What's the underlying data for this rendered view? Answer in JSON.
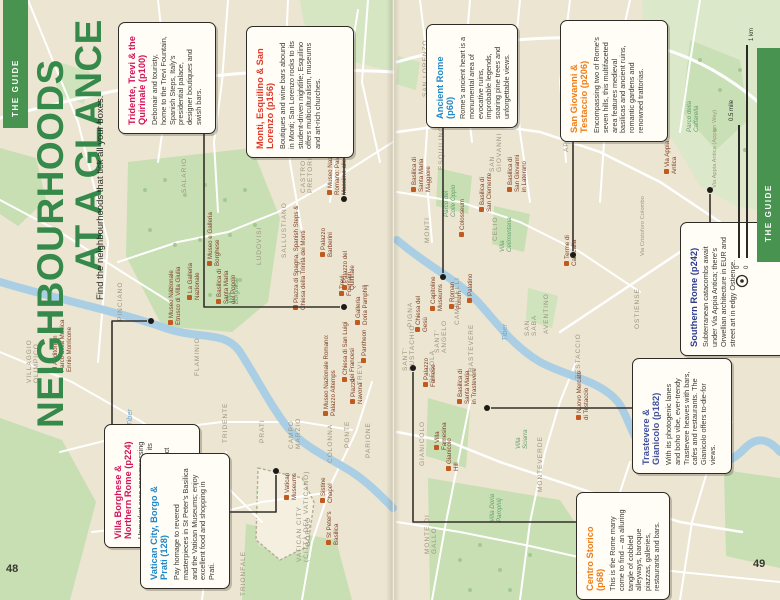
{
  "page": {
    "left_number": "48",
    "right_number": "49"
  },
  "guide_tab": "THE GUIDE",
  "header": {
    "title_line1": "NEIGHBOURHOODS",
    "title_line2": "AT A GLANCE",
    "subtitle": "Find the neighbourhoods that tick all your boxes.",
    "title_color": "#35894a"
  },
  "scale_bar": {
    "km_label": "1 km",
    "mile_label": "0.5 mile",
    "zero_km": "0",
    "zero_mile": "0"
  },
  "colors": {
    "band_green": "#47934f",
    "park_green": "#c7dfb3",
    "river_blue": "#aacfe5",
    "map_beige": "#ece5d1"
  },
  "callouts": [
    {
      "id": "tridente",
      "title": "Tridente, Trevi & the Quirinale (p100)",
      "color": "#d4145a",
      "body": "Debonair and touristy, home to the Trevi Fountain, Spanish Steps, Italy's presidential palace, designer boutiques and swish bars.",
      "box": [
        118,
        22,
        96,
        110
      ],
      "leader": [
        [
          204,
          132
        ],
        [
          204,
          307
        ],
        [
          340,
          307
        ]
      ],
      "dot": [
        344,
        307
      ]
    },
    {
      "id": "monti",
      "title": "Monti, Esquilino & San Lorenzo (p156)",
      "color": "#e0392a",
      "body": "Boutiques and wine bars abound in Monti; San Lorenzo rocks to its student-driven nightlife; Esquilino offers multiculturalism, museums and art-rich churches.",
      "box": [
        246,
        26,
        106,
        130
      ],
      "leader": [
        [
          344,
          156
        ],
        [
          344,
          195
        ]
      ],
      "dot": [
        344,
        199
      ]
    },
    {
      "id": "ancient-rome",
      "title": "Ancient Rome (p60)",
      "color": "#1f88c9",
      "body": "Rome's ancient heart is a monumental area of evocative ruins, improbable legends, soaring pine trees and unforgettable views.",
      "box": [
        426,
        24,
        90,
        102
      ],
      "leader": [
        [
          443,
          126
        ],
        [
          443,
          273
        ]
      ],
      "dot": [
        443,
        277
      ]
    },
    {
      "id": "san-giovanni",
      "title": "San Giovanni & Testaccio (p206)",
      "color": "#ef7d17",
      "body": "Encompassing two of Rome's seven hills, this multifaceted area features medieval basilicas and ancient ruins, romantic gardens and renowned trattorias.",
      "box": [
        560,
        20,
        106,
        120
      ],
      "leader": [
        [
          573,
          140
        ],
        [
          573,
          251
        ]
      ],
      "dot": [
        573,
        255
      ]
    },
    {
      "id": "villa-borghese",
      "title": "Villa Borghese & Northern Rome (p224)",
      "color": "#d4145a",
      "body": "Upmarket area encompassing Rome's most famous park, its top concert venue, most expensive residential district and several superlative museums.",
      "box": [
        104,
        424,
        94,
        122
      ],
      "leader": [
        [
          112,
          424
        ],
        [
          112,
          321
        ],
        [
          147,
          321
        ]
      ],
      "dot": [
        151,
        321
      ]
    },
    {
      "id": "vatican-city",
      "title": "Vatican City, Borgo & Prati (128)",
      "color": "#1f88c9",
      "body": "Pay homage to revered masterpieces in St Peter's Basilica and the Vatican Museums; enjoy excellent food and shopping in Prati.",
      "box": [
        140,
        453,
        88,
        134
      ],
      "leader": [
        [
          228,
          512
        ],
        [
          276,
          512
        ],
        [
          276,
          475
        ]
      ],
      "dot": [
        276,
        471
      ]
    },
    {
      "id": "southern-rome",
      "title": "Southern Rome (p242)",
      "color": "#2e3d8f",
      "body": "Subterranean catacombs await under Via Appia Antica; there's Orwellian architecture in EUR and street art in edgy Ostiense.",
      "box": [
        680,
        222,
        104,
        132
      ],
      "leader": [
        [
          710,
          222
        ],
        [
          710,
          194
        ]
      ],
      "dot": [
        710,
        190
      ]
    },
    {
      "id": "trastevere",
      "title": "Trastevere & Gianicolo (p182)",
      "color": "#41519e",
      "body": "With its photogenic lanes and boho vibe, ever-trendy Trastevere heaves with bars, cafes and restaurants. The Gianicolo offers to-die-for views.",
      "box": [
        632,
        358,
        98,
        114
      ],
      "leader": [
        [
          632,
          408
        ],
        [
          491,
          408
        ]
      ],
      "dot": [
        487,
        408
      ]
    },
    {
      "id": "centro-storico",
      "title": "Centro Storico (p68)",
      "color": "#ef7d17",
      "body": "This is the Rome many come to find – an alluring tangle of cobbled alleyways, baroque piazzas, galleries, restaurants and bars.",
      "box": [
        576,
        492,
        92,
        106
      ],
      "leader": [
        [
          576,
          522
        ],
        [
          413,
          522
        ],
        [
          413,
          372
        ]
      ],
      "dot": [
        413,
        368
      ]
    }
  ],
  "map_labels": {
    "districts": [
      {
        "t": "VILLAGGIO\nOLIMPICO",
        "x": 26,
        "y": 383
      },
      {
        "t": "FLAMINIO",
        "x": 194,
        "y": 376
      },
      {
        "t": "PINCIANO",
        "x": 117,
        "y": 321
      },
      {
        "t": "SALARIO",
        "x": 181,
        "y": 193
      },
      {
        "t": "SALLUSTIANO",
        "x": 281,
        "y": 258
      },
      {
        "t": "LUDOVISI",
        "x": 256,
        "y": 265
      },
      {
        "t": "CASTRO\nPRETORIO",
        "x": 300,
        "y": 193
      },
      {
        "t": "TRIDENTE",
        "x": 222,
        "y": 443
      },
      {
        "t": "CAMPO\nMARZIO",
        "x": 288,
        "y": 449
      },
      {
        "t": "COLONNA",
        "x": 327,
        "y": 463
      },
      {
        "t": "TREVI",
        "x": 357,
        "y": 385
      },
      {
        "t": "PRATI",
        "x": 259,
        "y": 443
      },
      {
        "t": "PONTE",
        "x": 344,
        "y": 448
      },
      {
        "t": "PARIONE",
        "x": 365,
        "y": 458
      },
      {
        "t": "BORGO",
        "x": 305,
        "y": 546
      },
      {
        "t": "TRIONFALE",
        "x": 240,
        "y": 596
      },
      {
        "t": "VATICAN CITY\n(CITTÀ DEL VATICANO)",
        "x": 296,
        "y": 562
      },
      {
        "t": "SAN LORENZO",
        "x": 422,
        "y": 97
      },
      {
        "t": "ESQUILINO",
        "x": 438,
        "y": 170
      },
      {
        "t": "MONTI",
        "x": 424,
        "y": 243
      },
      {
        "t": "SAN\nGIOVANNI",
        "x": 489,
        "y": 172
      },
      {
        "t": "APPIO LATINO",
        "x": 563,
        "y": 152
      },
      {
        "t": "CELIO",
        "x": 492,
        "y": 241
      },
      {
        "t": "AVENTINO",
        "x": 543,
        "y": 334
      },
      {
        "t": "SAN\nSABA",
        "x": 524,
        "y": 336
      },
      {
        "t": "TESTACCIO",
        "x": 575,
        "y": 379
      },
      {
        "t": "OSTIENSE",
        "x": 634,
        "y": 329
      },
      {
        "t": "SANT'\nEUSTACHIO",
        "x": 402,
        "y": 371
      },
      {
        "t": "PIGNA",
        "x": 407,
        "y": 327
      },
      {
        "t": "SANT'\nANGELO",
        "x": 434,
        "y": 353
      },
      {
        "t": "REGOLA",
        "x": 429,
        "y": 383
      },
      {
        "t": "TRASTEVERE",
        "x": 468,
        "y": 377
      },
      {
        "t": "CAMPITELLI",
        "x": 454,
        "y": 325
      },
      {
        "t": "GIANICOLO",
        "x": 419,
        "y": 466
      },
      {
        "t": "MONTEVERDE",
        "x": 537,
        "y": 492
      },
      {
        "t": "MONTE DI\nGALLO",
        "x": 424,
        "y": 554
      }
    ],
    "sights": [
      {
        "t": "Auditorium\nParco della Musica\nEnnio Morricone",
        "x": 52,
        "y": 372,
        "ic": 1
      },
      {
        "t": "Museo Nazionale\nEtrusco di Villa Giulia",
        "x": 168,
        "y": 325,
        "ic": 1
      },
      {
        "t": "La Galleria\nNazionale",
        "x": 187,
        "y": 300,
        "ic": 1
      },
      {
        "t": "Museo e Galleria\nBorghese",
        "x": 207,
        "y": 266,
        "ic": 1
      },
      {
        "t": "Basilica di\nSanta Maria\ndel Popolo",
        "x": 216,
        "y": 304,
        "ic": 1
      },
      {
        "t": "Piazza di Spagna, Spanish Steps &\nChiesa della Trinità dei Monti",
        "x": 293,
        "y": 310,
        "ic": 1
      },
      {
        "t": "Trevi\nFountain",
        "x": 339,
        "y": 296,
        "ic": 1
      },
      {
        "t": "Palazzo\nBarberini",
        "x": 320,
        "y": 257,
        "ic": 1
      },
      {
        "t": "Palazzo del\nQuirinale",
        "x": 342,
        "y": 290,
        "ic": 1
      },
      {
        "t": "Galleria\nDoria Pamphilj",
        "x": 355,
        "y": 325,
        "ic": 1
      },
      {
        "t": "Chiesa di San Luigi\ndei Francesi",
        "x": 342,
        "y": 382,
        "ic": 1
      },
      {
        "t": "Pantheon",
        "x": 361,
        "y": 363,
        "ic": 1
      },
      {
        "t": "Museo Nazionale Romano:\nPalazzo Altemps",
        "x": 323,
        "y": 416,
        "ic": 1
      },
      {
        "t": "Piazza\nNavona",
        "x": 350,
        "y": 404,
        "ic": 1
      },
      {
        "t": "Museo Nazionale\nRomano: Palazzo\nMassimo alle Terme",
        "x": 327,
        "y": 195,
        "ic": 1
      },
      {
        "t": "Vatican\nMuseums",
        "x": 284,
        "y": 500,
        "ic": 1
      },
      {
        "t": "Sistine\nChapel",
        "x": 320,
        "y": 503,
        "ic": 1
      },
      {
        "t": "St Peter's\nBasilica",
        "x": 326,
        "y": 545,
        "ic": 1
      },
      {
        "t": "Basilica di\nSanta Maria\nMaggiore",
        "x": 411,
        "y": 192,
        "ic": 1
      },
      {
        "t": "Basilica di\nSan Giovanni\nin Laterano",
        "x": 507,
        "y": 192,
        "ic": 1
      },
      {
        "t": "Basilica di\nSan Clemente",
        "x": 479,
        "y": 212,
        "ic": 1
      },
      {
        "t": "Colosseum",
        "x": 459,
        "y": 237,
        "ic": 1
      },
      {
        "t": "Capitoline\nMuseums",
        "x": 430,
        "y": 311,
        "ic": 1
      },
      {
        "t": "Roman\nForum",
        "x": 449,
        "y": 309,
        "ic": 1
      },
      {
        "t": "Palatino",
        "x": 467,
        "y": 303,
        "ic": 1
      },
      {
        "t": "Chiesa del\nGesù",
        "x": 415,
        "y": 332,
        "ic": 1
      },
      {
        "t": "Palazzo\nFarnese",
        "x": 423,
        "y": 387,
        "ic": 1
      },
      {
        "t": "Basilica di\nSanta Maria\nin Trastevere",
        "x": 457,
        "y": 404,
        "ic": 1
      },
      {
        "t": "Villa\nFarnesina",
        "x": 434,
        "y": 450,
        "ic": 1
      },
      {
        "t": "Gianicolo\nHill",
        "x": 446,
        "y": 471,
        "ic": 1
      },
      {
        "t": "Terme di\nCaracalla",
        "x": 564,
        "y": 266,
        "ic": 1
      },
      {
        "t": "Via Appia\nAntica",
        "x": 664,
        "y": 174,
        "ic": 1
      },
      {
        "t": "Nuovo Mercato\ndi Testaccio",
        "x": 576,
        "y": 420,
        "ic": 1
      }
    ],
    "parks": [
      {
        "t": "Villa\nBorghese",
        "x": 226,
        "y": 304
      },
      {
        "t": "Parco del\nColle Oppio",
        "x": 443,
        "y": 217
      },
      {
        "t": "Villa\nCelimontana",
        "x": 499,
        "y": 252
      },
      {
        "t": "Villa\nSciarra",
        "x": 515,
        "y": 449
      },
      {
        "t": "Villa Doria\nPamphilj",
        "x": 489,
        "y": 522
      },
      {
        "t": "Parco della\nCaffarella",
        "x": 686,
        "y": 132
      }
    ],
    "water": [
      {
        "t": "Tiber",
        "x": 126,
        "y": 426
      },
      {
        "t": "Tiber",
        "x": 501,
        "y": 341
      }
    ],
    "roads": [
      {
        "t": "Via Cristoforo Colombo",
        "x": 640,
        "y": 256
      },
      {
        "t": "Via Appia Antica (Appian Way)",
        "x": 712,
        "y": 188
      }
    ]
  }
}
